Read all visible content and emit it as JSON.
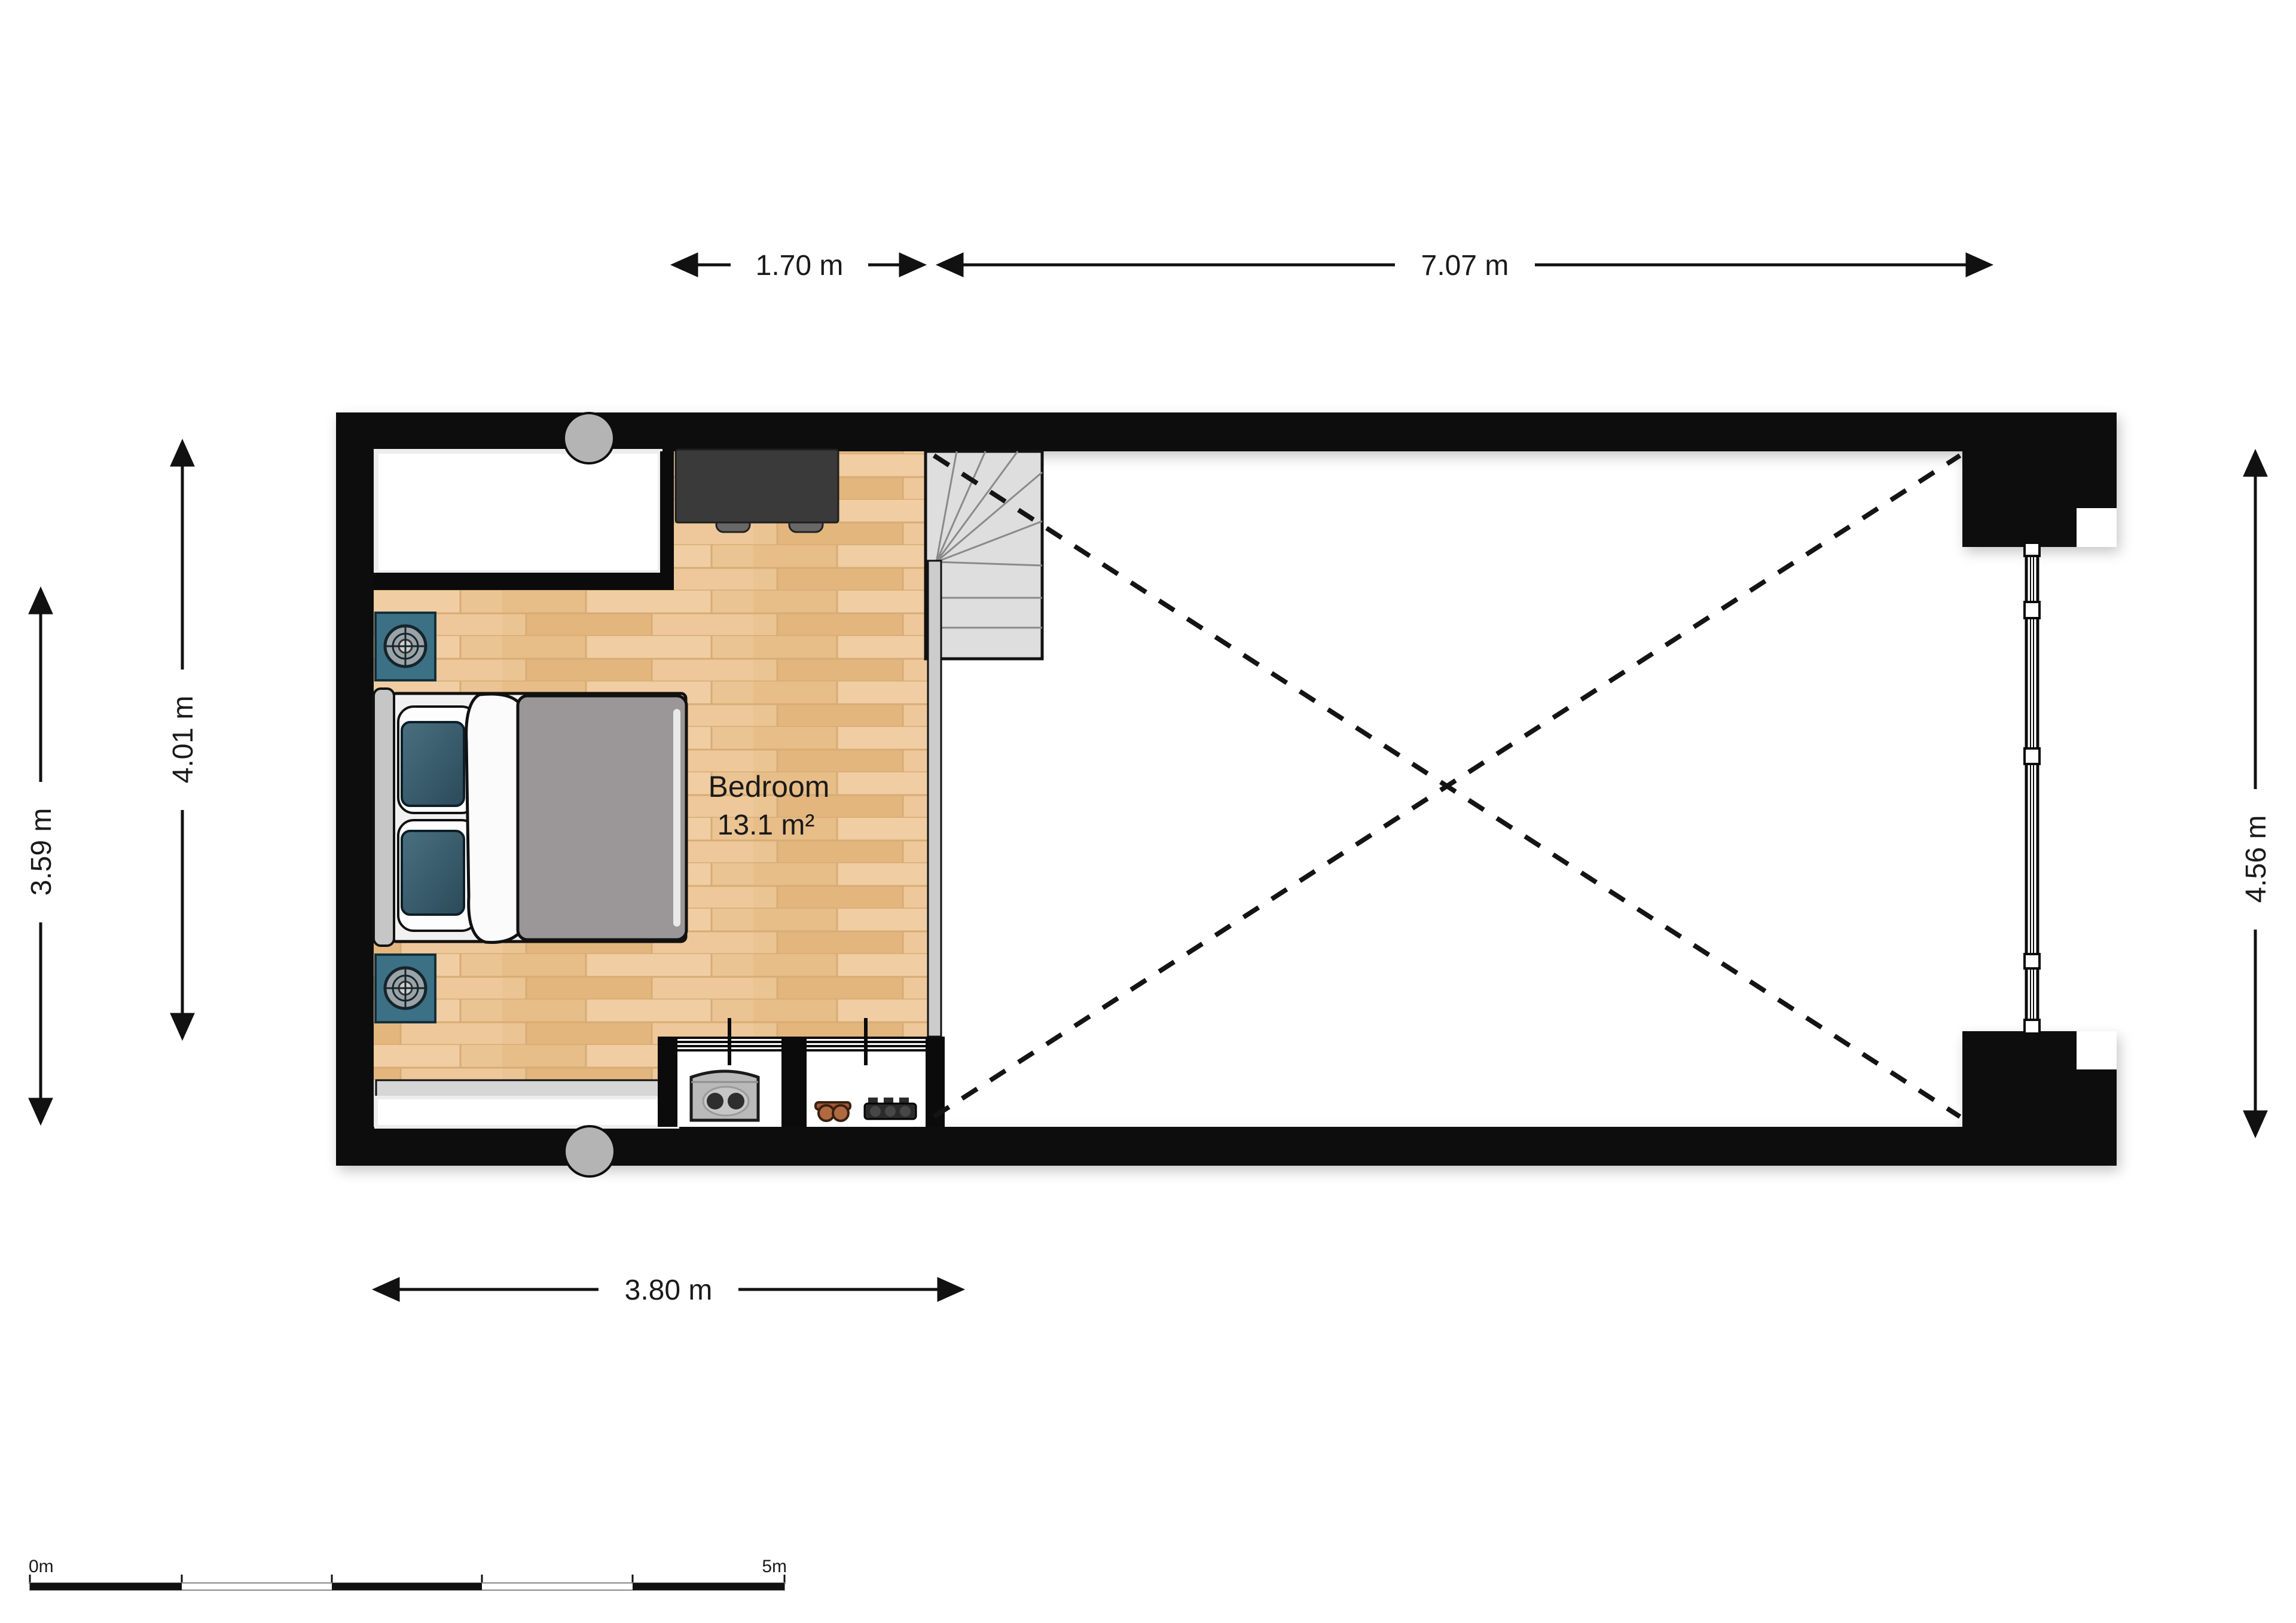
{
  "plan": {
    "room_label": {
      "name": "Bedroom",
      "area": "13.1 m²"
    },
    "dimensions": {
      "top_stairs": "1.70 m",
      "top_void": "7.07 m",
      "left_inner": "4.01 m",
      "left_outer": "3.59 m",
      "right_window": "4.56 m",
      "bottom_bedroom": "3.80 m"
    },
    "scale_bar": {
      "start": "0m",
      "end": "5m"
    },
    "colors": {
      "wall": "#0b0b0b",
      "floor_wood": "#ebc493",
      "accent_teal": "#3c7085",
      "stair_gray": "#dedede",
      "duvet_gray": "#9b9799",
      "desk_dark": "#3a3a3a",
      "column_gray": "#b4b4b4"
    }
  }
}
